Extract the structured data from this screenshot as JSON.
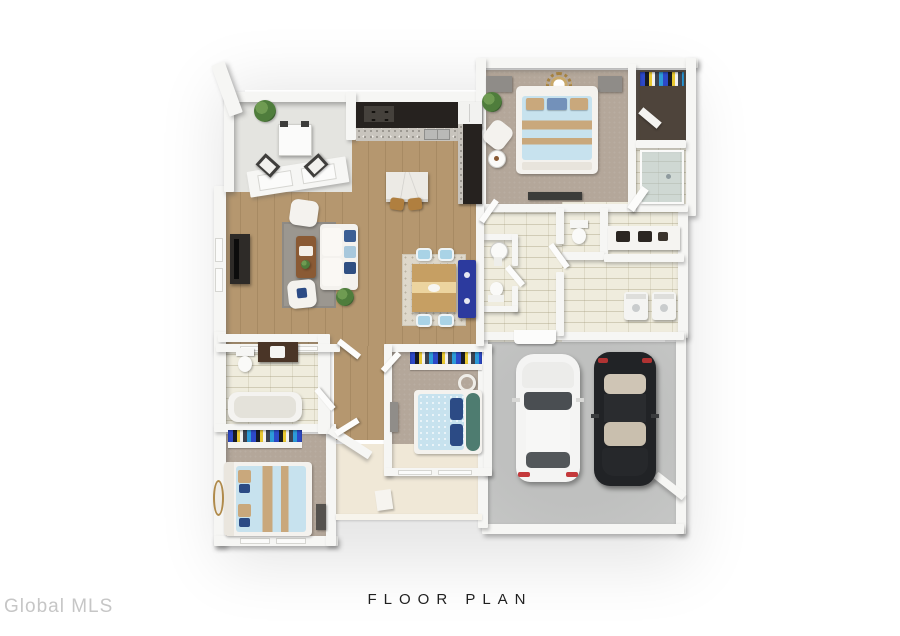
{
  "caption": {
    "title": "FLOOR PLAN"
  },
  "watermark": {
    "text": "Global MLS"
  },
  "palette": {
    "background": "#ffffff",
    "wall": "#f6f6f4",
    "wood_floor": "#b5976f",
    "wood_seam": "#a78a63",
    "carpet": "#b4a79a",
    "tile": "#efecdd",
    "nook_floor": "#e4e4e0",
    "porch_floor": "#f0e8d7",
    "garage_floor": "#c6c7c6",
    "closet_floor": "#4e443b",
    "counter_dark": "#26221f",
    "granite": "#c8c4bd",
    "marble": "#eceae5",
    "accent_blue": "#2c3a9e",
    "chair_blue": "#a9d3e6",
    "bed_blue": "#c7e2ee",
    "bed_tan": "#c9a87c",
    "pillow_navy": "#2c4b85",
    "teal_headboard": "#4e7c70",
    "rug_gray": "#9b9790",
    "dining_rug": "#ded8cb",
    "sofa_white": "#f4f2ee",
    "plant_green": "#4f7d3c",
    "car_white": "#f4f4f3",
    "car_black": "#212326",
    "caption_color": "#1f1f1f",
    "watermark_color": "#c6c6c6"
  },
  "plan": {
    "view": "3D top-down dollhouse floor plan render",
    "rooms": [
      {
        "name": "breakfast nook",
        "floor": "light gray",
        "contents": [
          "bistro table",
          "two dark chairs",
          "potted plant",
          "bay window"
        ]
      },
      {
        "name": "kitchen",
        "floor": "wood",
        "contents": [
          "dark L-shaped cabinets",
          "granite counter",
          "range",
          "double sink",
          "refrigerator",
          "marble island",
          "two wood stools"
        ]
      },
      {
        "name": "living room",
        "floor": "wood",
        "contents": [
          "white sofa with blue pillows",
          "two white armchairs",
          "wood coffee table",
          "gray area rug",
          "tv console",
          "potted plant"
        ]
      },
      {
        "name": "dining area",
        "floor": "wood",
        "contents": [
          "wood table",
          "four light-blue chairs",
          "patterned rug",
          "royal-blue buffet"
        ]
      },
      {
        "name": "primary bedroom",
        "floor": "carpet",
        "contents": [
          "bed with light-blue and tan bedding",
          "sunburst wall decor",
          "two dressers",
          "white accent chair",
          "round side table",
          "potted plant"
        ]
      },
      {
        "name": "walk-in closet",
        "floor": "dark wood",
        "contents": [
          "hanging clothes"
        ]
      },
      {
        "name": "primary bathroom",
        "floor": "tile",
        "contents": [
          "glass shower",
          "double vanity",
          "toilet room"
        ]
      },
      {
        "name": "laundry room",
        "floor": "tile",
        "contents": [
          "washer",
          "dryer"
        ]
      },
      {
        "name": "powder room",
        "floor": "tile",
        "contents": [
          "pedestal sink",
          "toilet"
        ]
      },
      {
        "name": "hall bathroom",
        "floor": "tile",
        "contents": [
          "toilet",
          "dark vanity",
          "bathtub"
        ]
      },
      {
        "name": "bedroom 2",
        "floor": "carpet",
        "contents": [
          "bed with teal headboard and navy pillows",
          "closet with clothes",
          "round mirror"
        ]
      },
      {
        "name": "bedroom 3",
        "floor": "carpet",
        "contents": [
          "bed with light-blue and tan bedding",
          "closet with clothes",
          "oval mirror"
        ]
      },
      {
        "name": "garage",
        "floor": "concrete",
        "contents": [
          "white car",
          "black car"
        ]
      },
      {
        "name": "front porch",
        "floor": "beige",
        "contents": [
          "entry step"
        ]
      }
    ]
  }
}
